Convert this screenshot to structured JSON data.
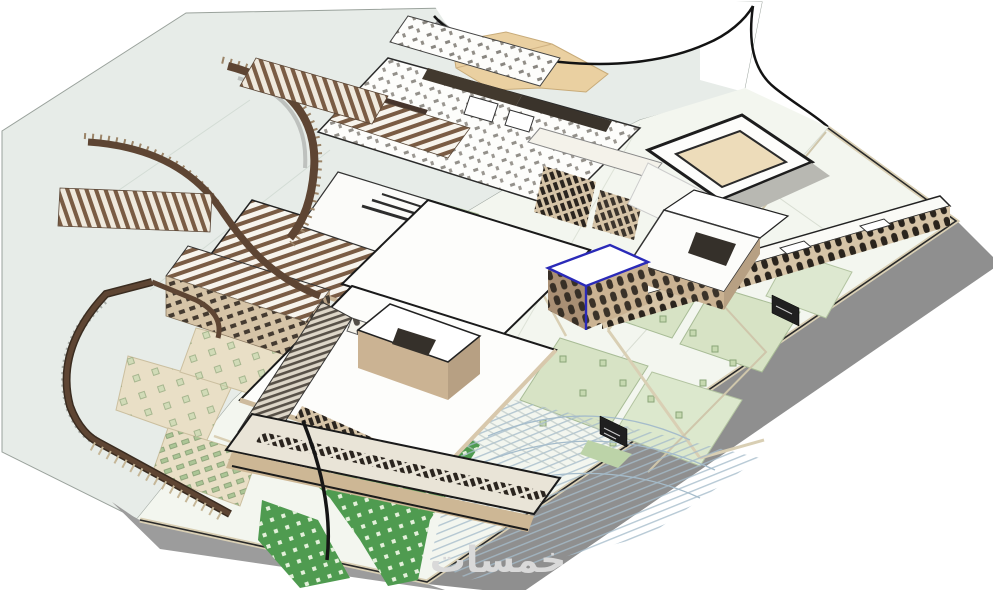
{
  "scene": {
    "watermark": "خمسات"
  },
  "colors": {
    "background": "#ffffff",
    "ground": "#e7ece8",
    "paving": "#f3f6ef",
    "paving_line": "#d9cfb4",
    "plaza": "#e9dfc6",
    "terrain": "#ead0a1",
    "lawn_bright": "#4f9b50",
    "lawn_pale": "#d7e3c5",
    "lawn_mid": "#c6d9b0",
    "wall_tan": "#d6c4a7",
    "wall_tan_dark": "#b7a083",
    "wall_front": "#cbb393",
    "roof_white": "#fdfdfb",
    "louver": "#7a5c44",
    "pergola": "#5e4533",
    "dark_detail": "#2b251f",
    "outline": "#1c1c1c",
    "shadow": "#8f8f8f",
    "shadow_light": "#b8b8b2",
    "selection": "#2a2ab8",
    "parking_line": "#a5bccb",
    "court": "#eddcba",
    "road_line": "#131313",
    "watermark": "#d9d9d9"
  }
}
